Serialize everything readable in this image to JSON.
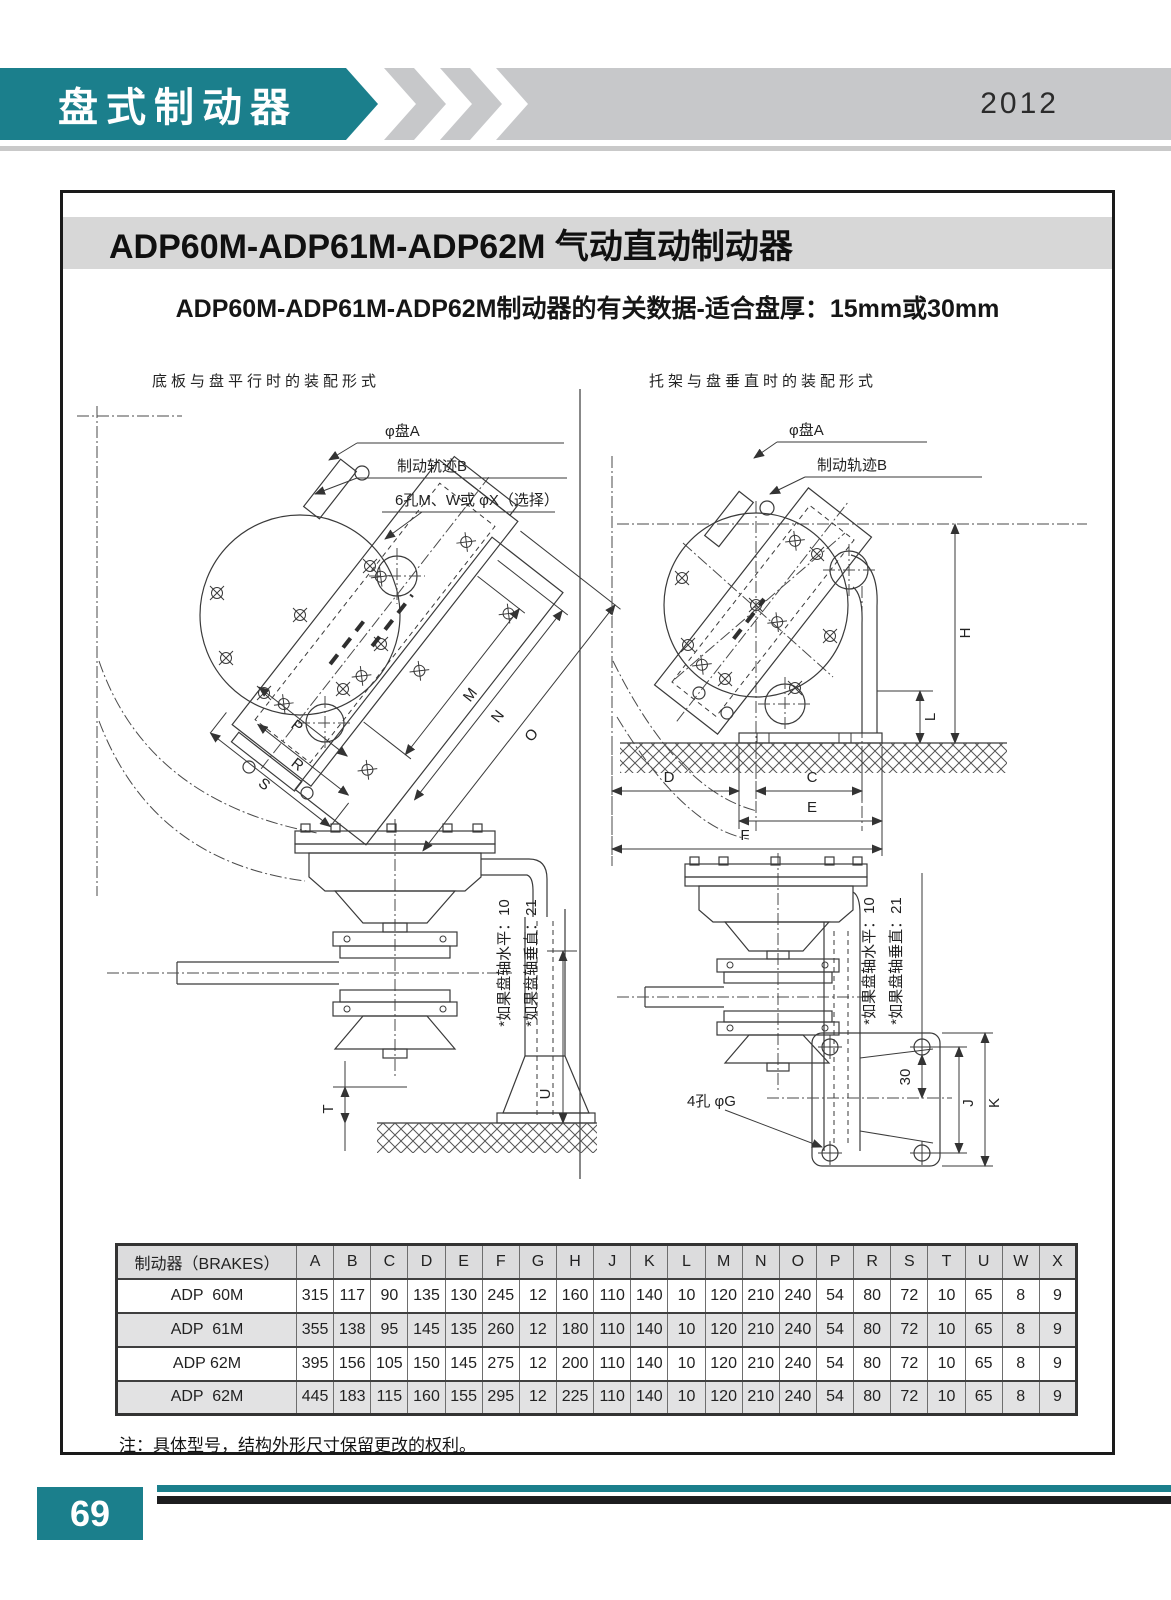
{
  "header": {
    "title": "盘式制动器",
    "year": "2012"
  },
  "content": {
    "title": "ADP60M-ADP61M-ADP62M 气动直动制动器",
    "subtitle": "ADP60M-ADP61M-ADP62M制动器的有关数据-适合盘厚：15mm或30mm",
    "note": "注：具体型号，结构外形尺寸保留更改的权利。"
  },
  "diagrams": {
    "left": {
      "caption": "底板与盘平行时的装配形式",
      "labels": {
        "disc_a": "φ盘A",
        "brake_track": "制动轨迹B",
        "holes": "6孔M、W或 φX（选择）",
        "dim_m": "M",
        "dim_n": "N",
        "dim_o": "O",
        "dim_p": "P",
        "dim_r": "R",
        "dim_s": "S",
        "dim_t": "T",
        "dim_u": "U",
        "note_horizontal": "*如果盘轴水平：10",
        "note_vertical": "*如果盘轴垂直：21"
      }
    },
    "right": {
      "caption": "托架与盘垂直时的装配形式",
      "labels": {
        "disc_a": "φ盘A",
        "brake_track": "制动轨迹B",
        "holes": "4孔 φG",
        "dim_h": "H",
        "dim_l": "L",
        "dim_d": "D",
        "dim_c": "C",
        "dim_e": "E",
        "dim_f": "F",
        "dim_30": "30",
        "dim_j": "J",
        "dim_k": "K",
        "note_horizontal": "*如果盘轴水平：10",
        "note_vertical": "*如果盘轴垂直：21"
      }
    }
  },
  "table": {
    "header_label": "制动器（BRAKES）",
    "columns": [
      "A",
      "B",
      "C",
      "D",
      "E",
      "F",
      "G",
      "H",
      "J",
      "K",
      "L",
      "M",
      "N",
      "O",
      "P",
      "R",
      "S",
      "T",
      "U",
      "W",
      "X"
    ],
    "rows": [
      {
        "model": "ADP  60M",
        "values": [
          315,
          117,
          90,
          135,
          130,
          245,
          12,
          160,
          110,
          140,
          10,
          120,
          210,
          240,
          54,
          80,
          72,
          10,
          65,
          8,
          9
        ]
      },
      {
        "model": "ADP  61M",
        "values": [
          355,
          138,
          95,
          145,
          135,
          260,
          12,
          180,
          110,
          140,
          10,
          120,
          210,
          240,
          54,
          80,
          72,
          10,
          65,
          8,
          9
        ]
      },
      {
        "model": "ADP 62M",
        "values": [
          395,
          156,
          105,
          150,
          145,
          275,
          12,
          200,
          110,
          140,
          10,
          120,
          210,
          240,
          54,
          80,
          72,
          10,
          65,
          8,
          9
        ]
      },
      {
        "model": "ADP  62M",
        "values": [
          445,
          183,
          115,
          160,
          155,
          295,
          12,
          225,
          110,
          140,
          10,
          120,
          210,
          240,
          54,
          80,
          72,
          10,
          65,
          8,
          9
        ]
      }
    ]
  },
  "footer": {
    "page_number": "69"
  },
  "colors": {
    "teal": "#1b7f8c",
    "chevron_gray": "#c7c8ca",
    "title_band_gray": "#d7d7d7",
    "table_header_gray": "#dcdcdd",
    "table_stripe_gray": "#e2e2e3",
    "footer_black": "#1d1d1f"
  }
}
